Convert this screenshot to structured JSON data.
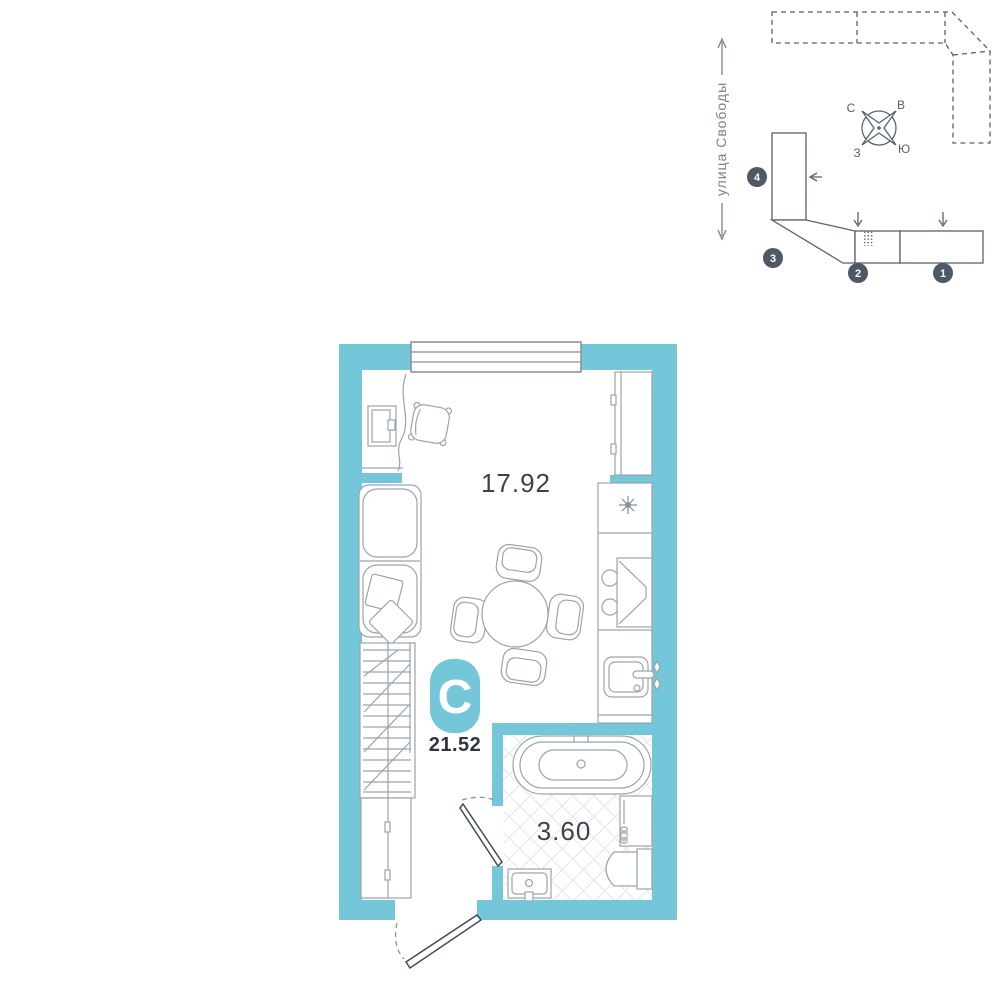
{
  "palette": {
    "wall_teal": "#74c7d8",
    "outline_dark": "#56626e",
    "furniture_gray": "#9aa4ad",
    "frame_gray": "#848f99",
    "tile_gray": "#e2e6e9",
    "badge_circle": "#4d5966",
    "text_dark": "#3d434d"
  },
  "site_plan": {
    "street_label": "улица Свободы",
    "compass": {
      "n": "С",
      "e": "В",
      "w": "З",
      "s": "Ю"
    },
    "sections": [
      {
        "number": "1"
      },
      {
        "number": "2"
      },
      {
        "number": "3"
      },
      {
        "number": "4"
      }
    ]
  },
  "floor_plan": {
    "unit_type_badge": "С",
    "total_area": "21.52",
    "living_area": "17.92",
    "bathroom_area": "3.60"
  }
}
